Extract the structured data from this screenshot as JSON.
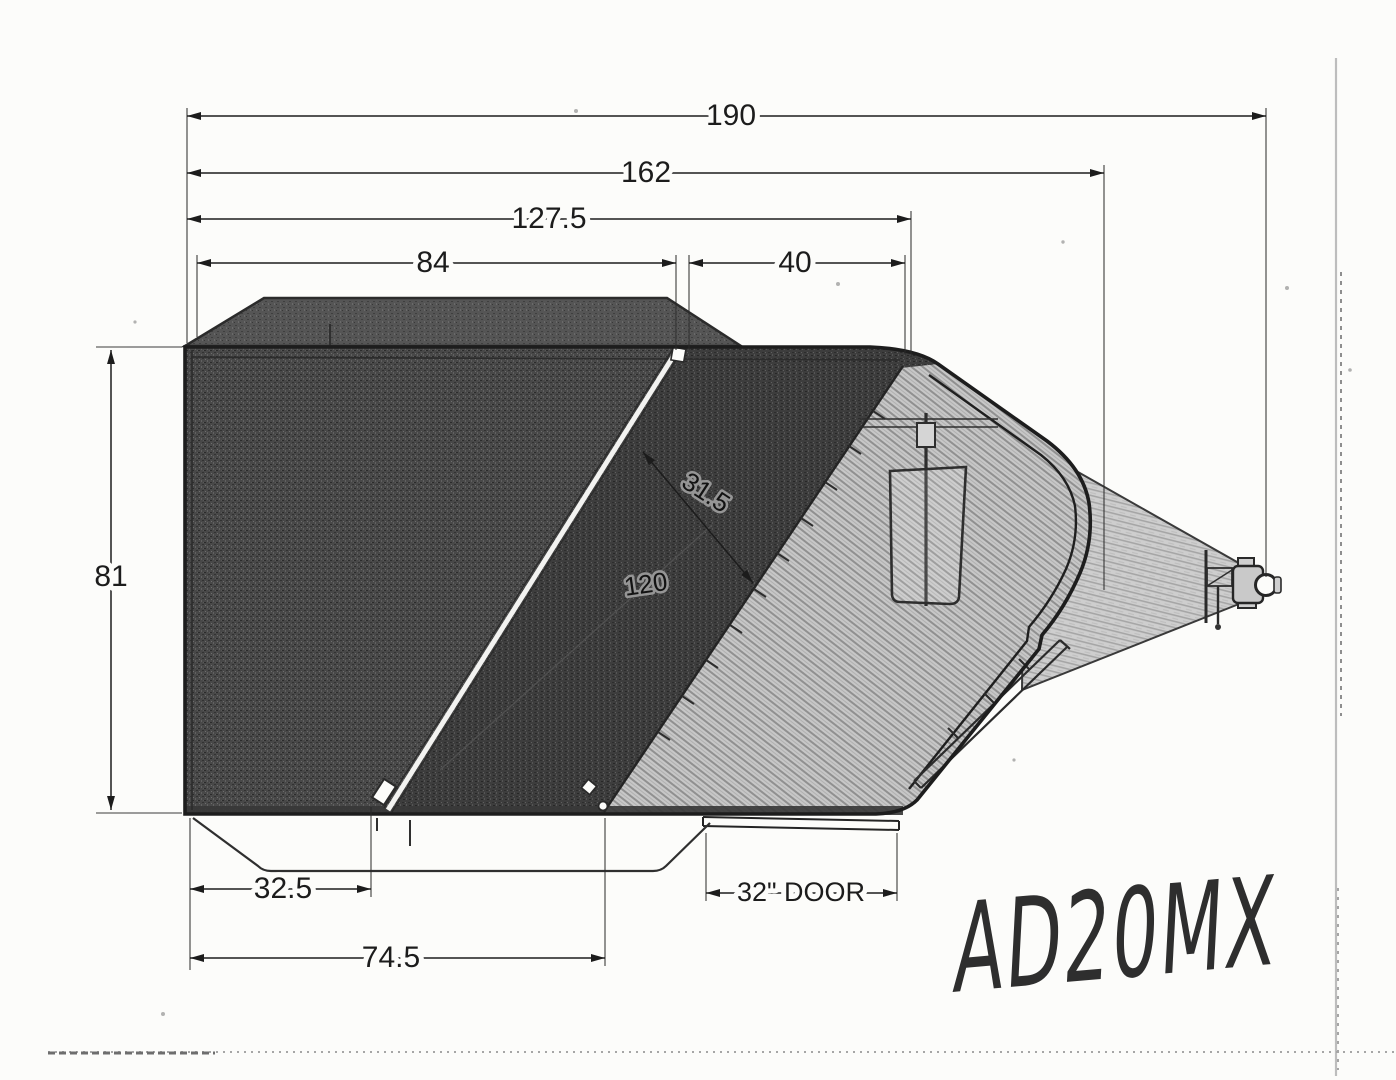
{
  "drawing": {
    "subject": "trailer-side-view",
    "annotations": {
      "model_code": "AD20MX"
    },
    "dimensions": {
      "overall_length": {
        "label": "190"
      },
      "length_to_nose": {
        "label": "162"
      },
      "body_top_length": {
        "label": "127.5"
      },
      "rear_top_length": {
        "label": "84"
      },
      "front_top_length": {
        "label": "40"
      },
      "body_height": {
        "label": "81"
      },
      "slope_panel_width": {
        "label": "31.5"
      },
      "incline_length": {
        "label": "120"
      },
      "rear_bottom_length": {
        "label": "32.5"
      },
      "bottom_to_incline": {
        "label": "74.5"
      },
      "side_door": {
        "label": "32\" DOOR"
      }
    }
  },
  "palette": {
    "paper": "#fcfcfa",
    "ink": "#1c1c1c",
    "body_dark": "#474747",
    "body_mid": "#3e3e3e",
    "body_light": "#c6c6c6",
    "wedge": "#cdcdcd",
    "artifact": "#bdbdbd"
  }
}
